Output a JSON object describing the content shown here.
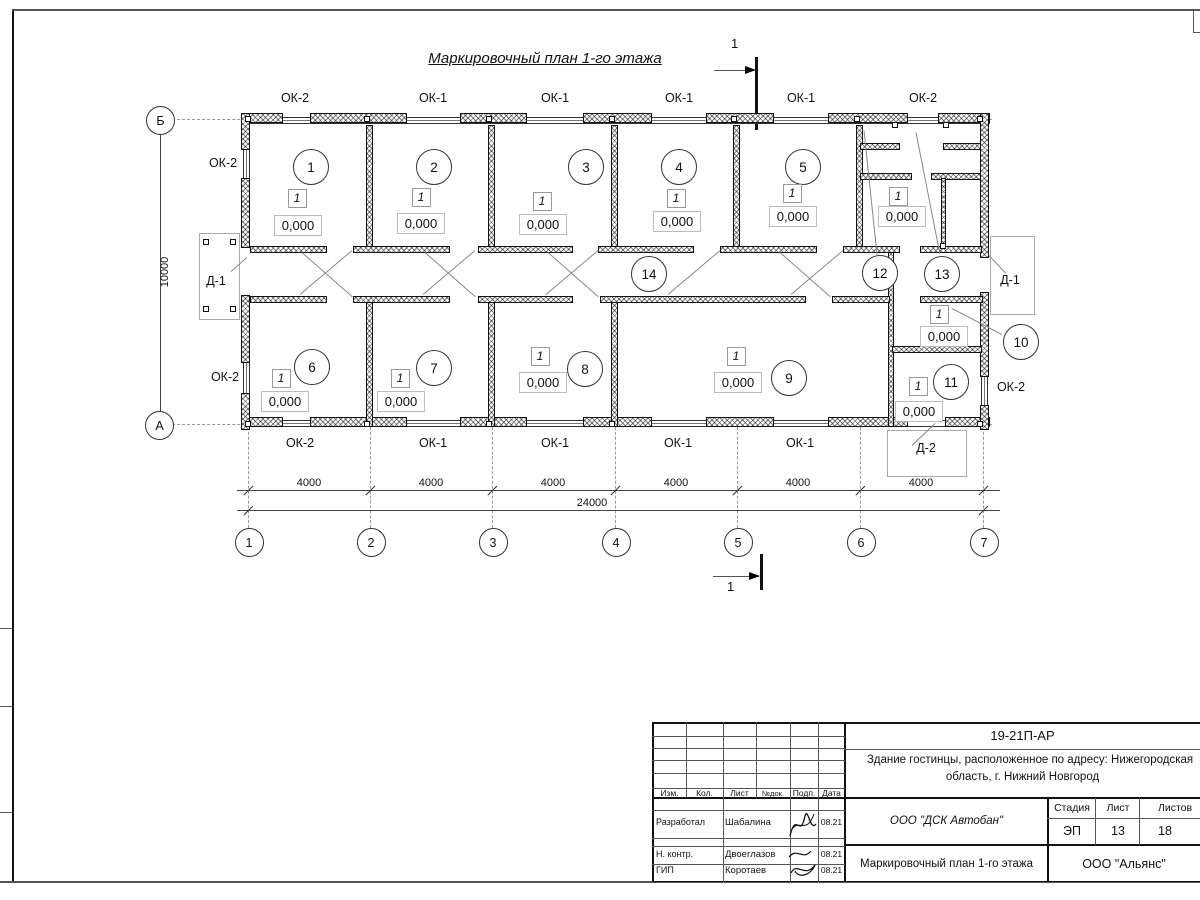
{
  "drawing": {
    "title": "Маркировочный план 1-го этажа",
    "section_label": "1"
  },
  "axes": {
    "bottom": [
      "1",
      "2",
      "3",
      "4",
      "5",
      "6",
      "7"
    ],
    "left_top": "Б",
    "left_bottom": "А"
  },
  "dims": {
    "bays": [
      "4000",
      "4000",
      "4000",
      "4000",
      "4000",
      "4000"
    ],
    "total": "24000",
    "vertical": "10000"
  },
  "labels": {
    "windows_top": [
      "ОК-2",
      "ОК-1",
      "ОК-1",
      "ОК-1",
      "ОК-1",
      "ОК-2"
    ],
    "windows_bottom": [
      "ОК-2",
      "ОК-1",
      "ОК-1",
      "ОК-1",
      "ОК-1"
    ],
    "window_left_upper": "ОК-2",
    "window_left_lower": "ОК-2",
    "window_right": "ОК-2",
    "door_left": "Д-1",
    "door_right": "Д-1",
    "door_bottom": "Д-2"
  },
  "rooms": {
    "type_mark": "1",
    "elevation": "0,000",
    "circles": [
      {
        "n": "1",
        "x": 310,
        "y": 166
      },
      {
        "n": "2",
        "x": 433,
        "y": 166
      },
      {
        "n": "3",
        "x": 585,
        "y": 166
      },
      {
        "n": "4",
        "x": 678,
        "y": 166
      },
      {
        "n": "5",
        "x": 802,
        "y": 166
      },
      {
        "n": "6",
        "x": 311,
        "y": 366
      },
      {
        "n": "7",
        "x": 433,
        "y": 367
      },
      {
        "n": "8",
        "x": 584,
        "y": 368
      },
      {
        "n": "9",
        "x": 788,
        "y": 377
      },
      {
        "n": "10",
        "x": 1020,
        "y": 341
      },
      {
        "n": "11",
        "x": 950,
        "y": 381
      },
      {
        "n": "12",
        "x": 879,
        "y": 272
      },
      {
        "n": "13",
        "x": 941,
        "y": 273
      },
      {
        "n": "14",
        "x": 648,
        "y": 273
      }
    ],
    "squares": [
      {
        "x": 296,
        "y": 197
      },
      {
        "x": 420,
        "y": 196
      },
      {
        "x": 541,
        "y": 200
      },
      {
        "x": 675,
        "y": 197
      },
      {
        "x": 791,
        "y": 192
      },
      {
        "x": 897,
        "y": 195
      },
      {
        "x": 280,
        "y": 377
      },
      {
        "x": 399,
        "y": 377
      },
      {
        "x": 539,
        "y": 355
      },
      {
        "x": 735,
        "y": 355
      },
      {
        "x": 938,
        "y": 313
      },
      {
        "x": 917,
        "y": 385
      }
    ],
    "elevations": [
      {
        "x": 297,
        "y": 224
      },
      {
        "x": 420,
        "y": 222
      },
      {
        "x": 542,
        "y": 223
      },
      {
        "x": 676,
        "y": 220
      },
      {
        "x": 792,
        "y": 215
      },
      {
        "x": 901,
        "y": 215
      },
      {
        "x": 284,
        "y": 400
      },
      {
        "x": 400,
        "y": 400
      },
      {
        "x": 542,
        "y": 381
      },
      {
        "x": 737,
        "y": 381
      },
      {
        "x": 943,
        "y": 335
      },
      {
        "x": 918,
        "y": 410
      }
    ]
  },
  "titleblock": {
    "doc_code": "19-21П-АР",
    "object_line1": "Здание гостинцы, расположенное по адресу: Нижегородская",
    "object_line2": "область, г. Нижний Новгород",
    "header_cols": [
      "Изм.",
      "Кол.",
      "Лист",
      "№док.",
      "Подп.",
      "Дата"
    ],
    "rows": [
      {
        "role": "Разработал",
        "name": "Шабалина",
        "date": "08.21"
      },
      {
        "role": "Н. контр.",
        "name": "Двоеглазов",
        "date": "08.21"
      },
      {
        "role": "ГИП",
        "name": "Коротаев",
        "date": "08.21"
      }
    ],
    "org": "ООО \"ДСК Автобан\"",
    "sheet_title": "Маркировочный план 1-го этажа",
    "company": "ООО \"Альянс\"",
    "stage_label": "Стадия",
    "sheet_label": "Лист",
    "sheets_label": "Листов",
    "stage": "ЭП",
    "sheet_no": "13",
    "sheets_total": "18"
  }
}
